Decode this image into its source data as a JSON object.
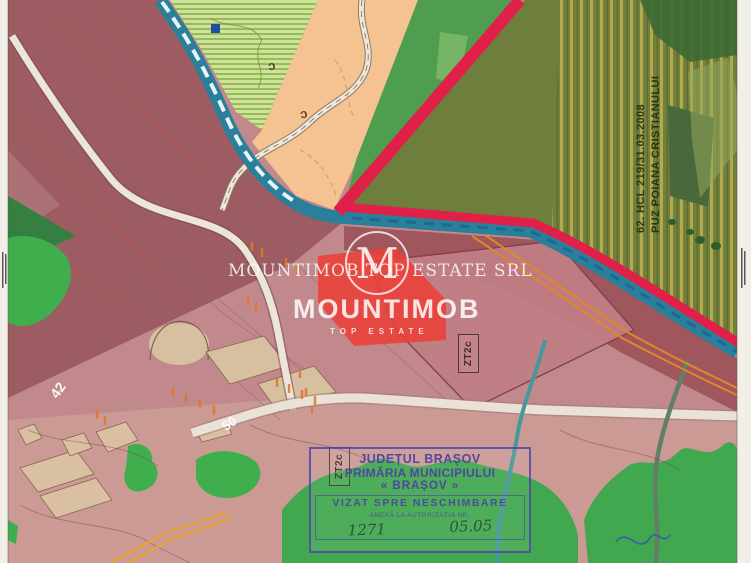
{
  "watermark": {
    "company_line": "MOUNTIMOB TOP ESTATE SRL",
    "brand": "MOUNTIMOB",
    "brand_sub": "TOP ESTATE",
    "monogram": "M"
  },
  "labels": {
    "puz_note_line1": "62. HCL 219/31.03.2008",
    "puz_note_line2": "PUZ POIANA CRISTIANULUI",
    "zone_code_a": "ZT2c",
    "zone_code_b": "ZT2c",
    "parcel_number_42": "42",
    "parcel_number_50": "50",
    "road_letter_a": "c",
    "road_letter_b": "c"
  },
  "stamp": {
    "county": "JUDEȚUL BRAȘOV",
    "authority": "PRIMĂRIA MUNICIPIULUI",
    "city": "« BRAȘOV »",
    "visa": "VIZAT SPRE NESCHIMBARE",
    "annex": "ANEXĂ LA AUTORIZAȚIA NR.",
    "number": "1271",
    "date": "05.05"
  },
  "colors": {
    "pink_base": "#c2898c",
    "pink_light": "#cb9a95",
    "mauve_zone": "#9c5c61",
    "teal_road": "#2a7f9b",
    "red_boundary": "#e02048",
    "olive_zone": "#6e7f3d",
    "peach_zone": "#f4c391",
    "green_zone": "#4f9e50",
    "bright_green": "#3fae4d",
    "lime_hatch": "#cfe19b",
    "orange_utility": "#e0862c",
    "stamp_ink": "#5246a8",
    "watermark_white": "rgba(255,255,255,0.82)"
  }
}
